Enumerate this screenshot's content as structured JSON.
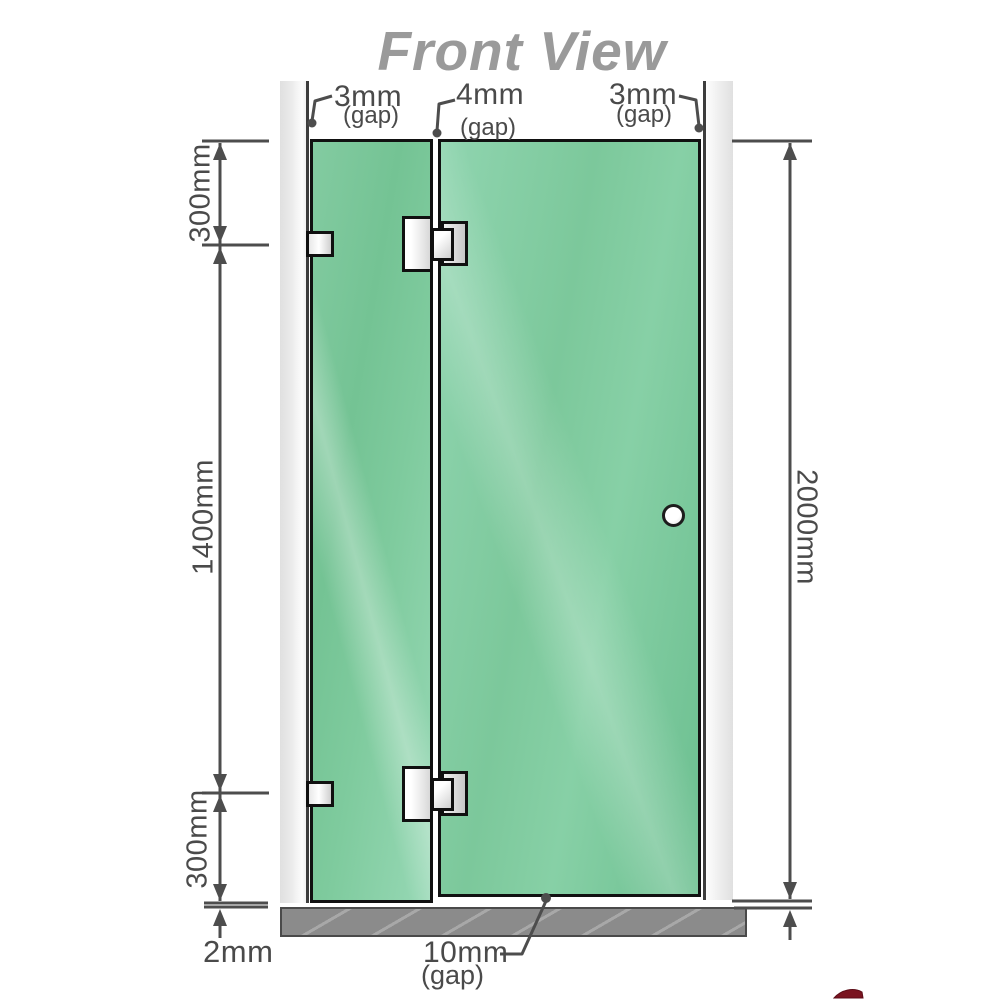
{
  "title": "Front View",
  "annotations": {
    "gap_top_left": {
      "value": "3mm",
      "note": "(gap)"
    },
    "gap_top_middle": {
      "value": "4mm",
      "note": "(gap)"
    },
    "gap_top_right": {
      "value": "3mm",
      "note": "(gap)"
    },
    "height_top_segment": "300mm",
    "height_middle_segment": "1400mm",
    "height_bottom_segment": "300mm",
    "height_total": "2000mm",
    "floor_clearance": "2mm",
    "bottom_gap": {
      "value": "10mm",
      "note": "(gap)"
    }
  },
  "colors": {
    "glass_green": "#7cc89b",
    "wall_channel_gray": "#e9e9e9",
    "floor_gray": "#8b8b8b",
    "dimension_gray": "#4d4d4d",
    "title_gray": "#9a9a9a",
    "outline_black": "#111111",
    "logo_red": "#7a1420"
  }
}
